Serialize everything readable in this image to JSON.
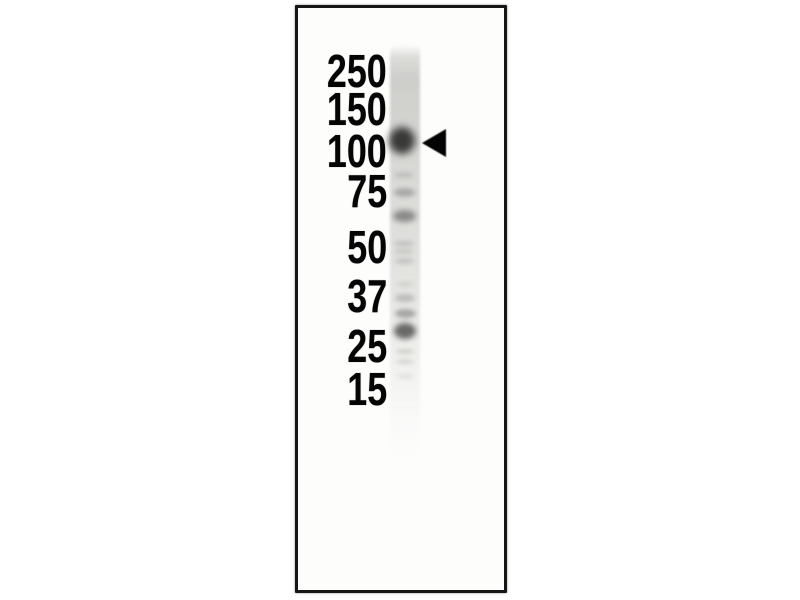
{
  "colors": {
    "background": "#ffffff",
    "panel_background": "#fdfdfc",
    "panel_border": "#161616",
    "label_text": "#050505",
    "band_ink": "#161616",
    "lane_tint": "#d4d4d1",
    "arrow": "#040404"
  },
  "ladder": {
    "right_edge_x": 387,
    "labels": [
      {
        "text": "250",
        "y": 71
      },
      {
        "text": "150",
        "y": 109
      },
      {
        "text": "100",
        "y": 151
      },
      {
        "text": "75",
        "y": 191
      },
      {
        "text": "50",
        "y": 247
      },
      {
        "text": "37",
        "y": 296
      },
      {
        "text": "25",
        "y": 346
      },
      {
        "text": "15",
        "y": 389
      }
    ]
  },
  "lane": {
    "x": 390,
    "width": 30,
    "top": 45,
    "bottom": 457
  },
  "arrow": {
    "tip_x": 422,
    "center_y": 143,
    "width": 24,
    "height": 28,
    "direction": "left",
    "points_at_marker": "100"
  },
  "bands": [
    {
      "cx": 402,
      "y": 140,
      "width": 26,
      "height": 27,
      "intensity": 0.82,
      "blur": 4,
      "note": "strong band marked by arrow, aligned with 100"
    },
    {
      "cx": 404,
      "y": 175,
      "width": 20,
      "height": 6,
      "intensity": 0.13,
      "blur": 2,
      "note": "faint band"
    },
    {
      "cx": 404,
      "y": 192,
      "width": 21,
      "height": 9,
      "intensity": 0.25,
      "blur": 2.5,
      "note": "faint band above 75"
    },
    {
      "cx": 404,
      "y": 216,
      "width": 23,
      "height": 12,
      "intensity": 0.42,
      "blur": 3,
      "note": "medium band between 75 and 50"
    },
    {
      "cx": 404,
      "y": 243,
      "width": 20,
      "height": 5,
      "intensity": 0.16,
      "blur": 2,
      "note": "faint band near 50"
    },
    {
      "cx": 404,
      "y": 251,
      "width": 20,
      "height": 5,
      "intensity": 0.13,
      "blur": 2,
      "note": "faint band near 50"
    },
    {
      "cx": 404,
      "y": 261,
      "width": 19,
      "height": 6,
      "intensity": 0.14,
      "blur": 2,
      "note": "faint band below 50"
    },
    {
      "cx": 405,
      "y": 284,
      "width": 18,
      "height": 5,
      "intensity": 0.09,
      "blur": 2,
      "note": "very faint band"
    },
    {
      "cx": 405,
      "y": 298,
      "width": 20,
      "height": 8,
      "intensity": 0.2,
      "blur": 2.5,
      "note": "faint band at 37"
    },
    {
      "cx": 405,
      "y": 313,
      "width": 21,
      "height": 9,
      "intensity": 0.32,
      "blur": 2.5,
      "note": "medium band below 37"
    },
    {
      "cx": 405,
      "y": 331,
      "width": 22,
      "height": 16,
      "intensity": 0.62,
      "blur": 3,
      "note": "dark band between 37 and 25"
    },
    {
      "cx": 405,
      "y": 351,
      "width": 18,
      "height": 5,
      "intensity": 0.14,
      "blur": 2,
      "note": "faint band near 25"
    },
    {
      "cx": 405,
      "y": 361,
      "width": 18,
      "height": 5,
      "intensity": 0.12,
      "blur": 2,
      "note": "faint band below 25"
    },
    {
      "cx": 405,
      "y": 376,
      "width": 17,
      "height": 5,
      "intensity": 0.08,
      "blur": 2,
      "note": "very faint band near 15"
    }
  ]
}
